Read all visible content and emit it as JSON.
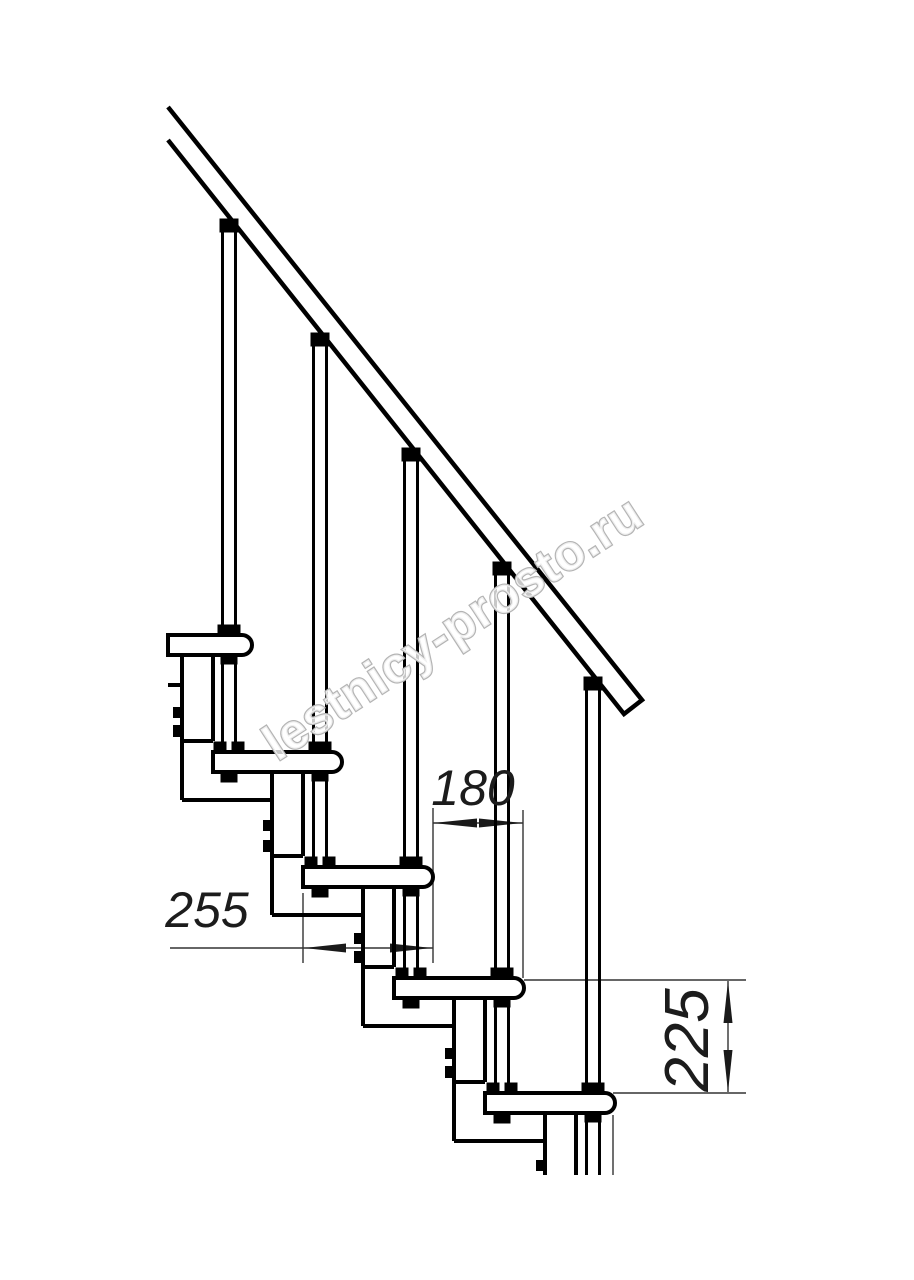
{
  "watermark": {
    "text": "lestnicy-prosto.ru"
  },
  "dimensions": {
    "tread_depth": "255",
    "going_between_nosings": "180",
    "riser_height": "225"
  },
  "colors": {
    "line": "#000000",
    "dimension_line": "#333333",
    "dimension_text": "#1c1c1c",
    "watermark_outline": "#b4b4b4",
    "background": "#ffffff"
  }
}
